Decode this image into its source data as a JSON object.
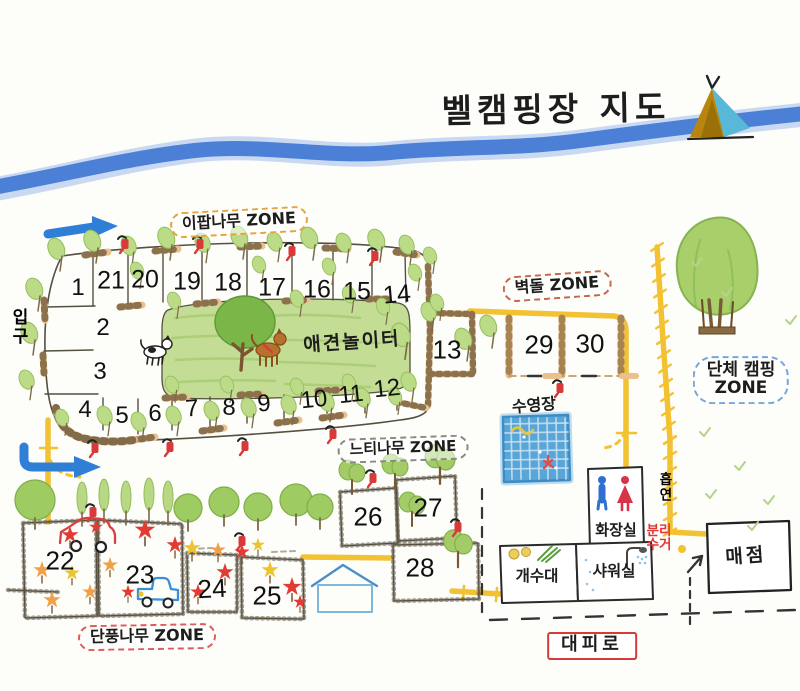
{
  "title": "벨캠핑장 지도",
  "zones": {
    "ipap": "이팝나무 ZONE",
    "brick": "벽돌 ZONE",
    "group_line1": "단체 캠핑",
    "group_line2": "ZONE",
    "zelkova": "느티나무 ZONE",
    "maple": "단풍나무 ZONE"
  },
  "labels": {
    "entrance": "입구",
    "dog_playground": "애견놀이터",
    "pool": "수영장",
    "restroom": "화장실",
    "smoking": "흡연",
    "recycling_line1": "분리",
    "recycling_line2": "수거",
    "sink": "개수대",
    "shower": "샤워실",
    "store": "매점",
    "evacuation_route": "대피로"
  },
  "sites": {
    "numbers": [
      "1",
      "2",
      "3",
      "4",
      "5",
      "6",
      "7",
      "8",
      "9",
      "10",
      "11",
      "12",
      "13",
      "14",
      "15",
      "16",
      "17",
      "18",
      "19",
      "20",
      "21",
      "22",
      "23",
      "24",
      "25",
      "26",
      "27",
      "28",
      "29",
      "30"
    ]
  },
  "icons": {
    "tent": "tent-icon",
    "water_tap": "water-tap-icon",
    "tree": "tree-icon",
    "maple_leaf": "maple-leaf-icon",
    "restroom_man": "man-icon",
    "restroom_woman": "woman-icon",
    "swing_tree": "swing-tree-icon",
    "shelter": "shelter-icon",
    "car": "car-icon",
    "truck": "truck-icon",
    "dog": "dog-icon",
    "entry_arrow": "direction-arrow-icon",
    "store_arrow": "store-arrow-icon",
    "shower_head": "shower-head-icon",
    "vegetables": "vegetables-icon",
    "swimmer": "swimmer-icon"
  },
  "colors": {
    "river": "#4c80d6",
    "road": "#f2c232",
    "grass": "#c3dd95",
    "zone_ipap_border": "#e8a43c",
    "zone_brick_border": "#c4684a",
    "zone_group_border": "#74a8dc",
    "zone_zelkova_border": "#8a8a80",
    "zone_maple_border": "#e05c5c",
    "evacuation_red": "#d83a3a"
  }
}
